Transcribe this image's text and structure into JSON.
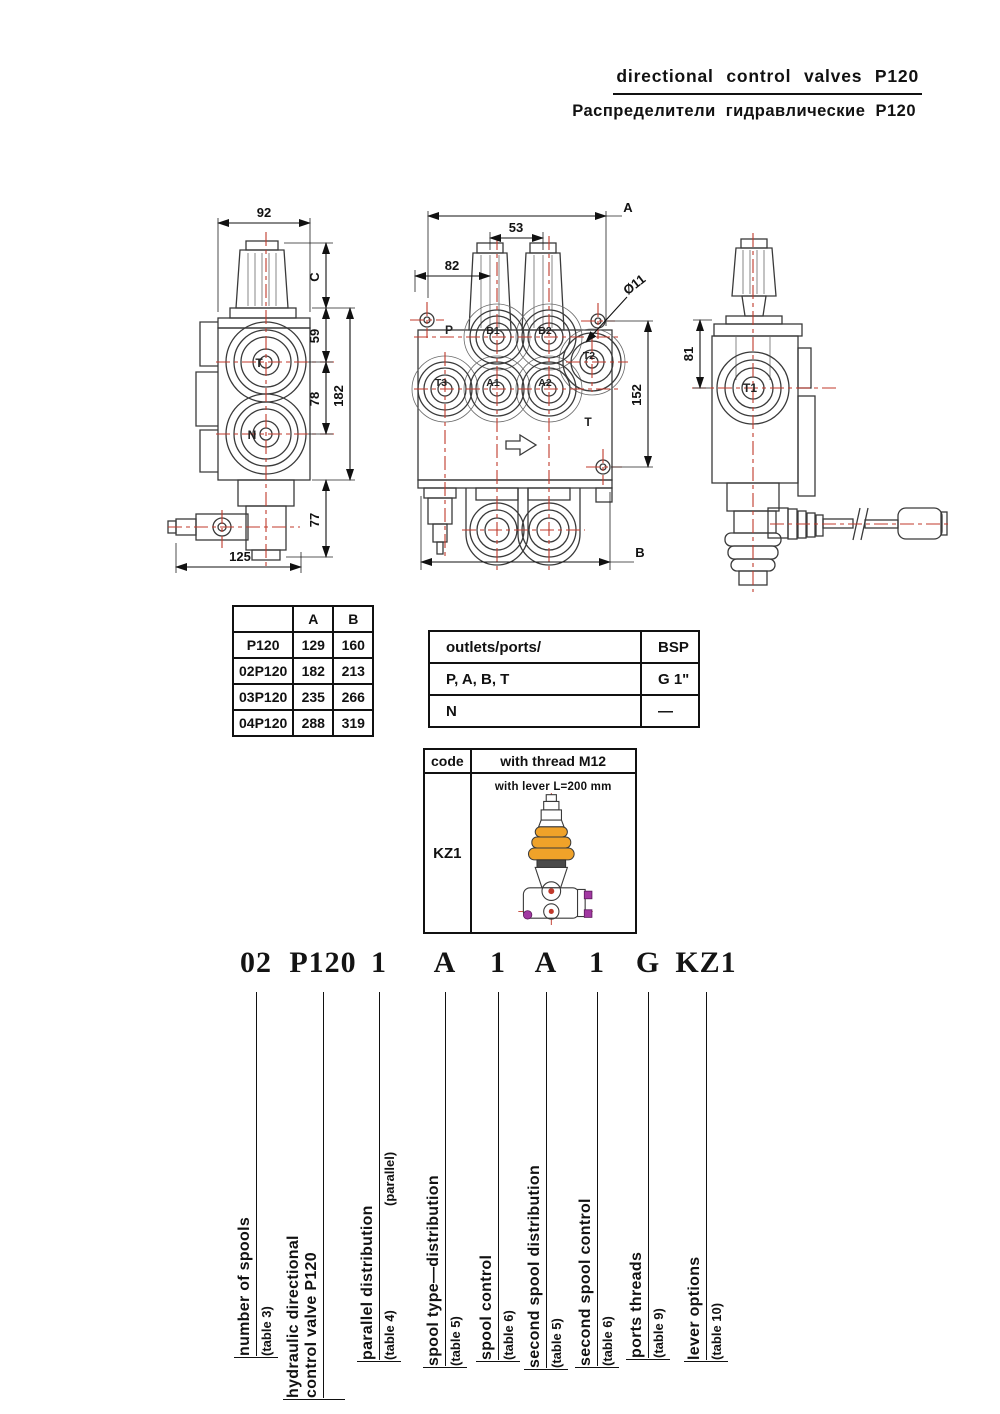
{
  "header": {
    "title_en": "directional control valves P120",
    "title_ru": "Распределители гидравлические P120"
  },
  "drawings": {
    "left_view": {
      "dims": {
        "w": "92",
        "c": "C",
        "d59": "59",
        "d78": "78",
        "d182": "182",
        "d77": "77",
        "d125": "125"
      },
      "ports": {
        "t": "T",
        "n": "N"
      }
    },
    "front_view": {
      "dims": {
        "a": "A",
        "d53": "53",
        "d82": "82",
        "dia": "Ø11",
        "d152": "152",
        "b": "B"
      },
      "ports": {
        "p": "P",
        "b1": "B1",
        "b2": "B2",
        "t2": "T2",
        "t3": "T3",
        "a1": "A1",
        "a2": "A2",
        "t": "T"
      }
    },
    "right_view": {
      "dims": {
        "d81": "81"
      },
      "ports": {
        "t1": "T1"
      }
    }
  },
  "size_table": {
    "headers": [
      "",
      "A",
      "B"
    ],
    "rows": [
      [
        "P120",
        "129",
        "160"
      ],
      [
        "02P120",
        "182",
        "213"
      ],
      [
        "03P120",
        "235",
        "266"
      ],
      [
        "04P120",
        "288",
        "319"
      ]
    ]
  },
  "ports_table": {
    "header": [
      "outlets/ports/",
      "BSP"
    ],
    "rows": [
      [
        "P, A, B, T",
        "G 1\""
      ],
      [
        "N",
        "—"
      ]
    ]
  },
  "code_table": {
    "headers": [
      "code",
      "with thread M12"
    ],
    "code": "KZ1",
    "caption": "with lever L=200 mm"
  },
  "ordering": {
    "items": [
      {
        "code": "02",
        "lines": [
          "number of spools"
        ],
        "ref": "(table 3)"
      },
      {
        "code": "P120",
        "lines": [
          "hydraulic directional",
          "control valve P120"
        ],
        "ref": ""
      },
      {
        "code": "1",
        "lines": [
          "parallel distribution"
        ],
        "ref": "(table 4)",
        "extra": "(parallel)"
      },
      {
        "code": "A",
        "lines": [
          "spool type—distribution"
        ],
        "ref": "(table 5)"
      },
      {
        "code": "1",
        "lines": [
          "spool control"
        ],
        "ref": "(table 6)"
      },
      {
        "code": "A",
        "lines": [
          "second spool distribution"
        ],
        "ref": "(table 5)"
      },
      {
        "code": "1",
        "lines": [
          "second spool control"
        ],
        "ref": "(table 6)"
      },
      {
        "code": "G",
        "lines": [
          "ports threads"
        ],
        "ref": "(table 9)"
      },
      {
        "code": "KZ1",
        "lines": [
          "lever options"
        ],
        "ref": "(table 10)"
      }
    ]
  },
  "colors": {
    "centerline_red": "#c0392b",
    "bellows_orange": "#f0a229",
    "accent_magenta": "#a238a2",
    "line_dark": "#3a3a3a"
  }
}
